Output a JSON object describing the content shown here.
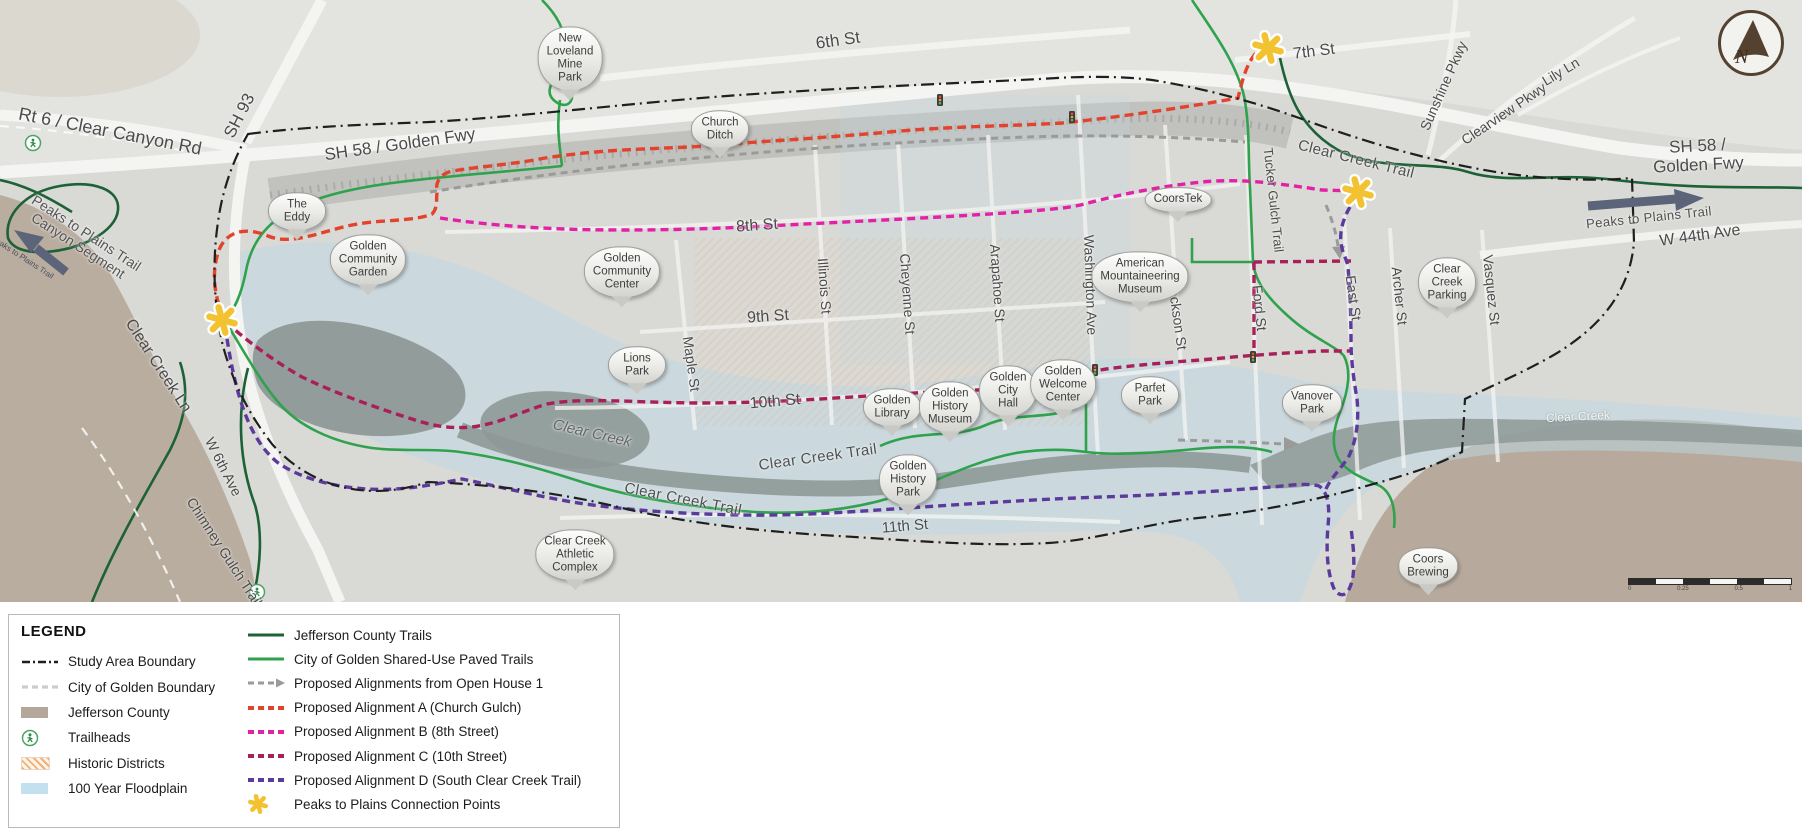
{
  "map": {
    "compass_letter": "N",
    "labels": [
      {
        "t": "Rt 6 / Clear Canyon Rd",
        "x": 110,
        "y": 132,
        "r": 11,
        "s": 18,
        "k": "street"
      },
      {
        "t": "SH 93",
        "x": 240,
        "y": 116,
        "r": -63,
        "s": 17,
        "k": "street"
      },
      {
        "t": "SH 58 / Golden Fwy",
        "x": 400,
        "y": 145,
        "r": -8,
        "s": 17,
        "k": "street"
      },
      {
        "t": "SH 58 / Golden Fwy",
        "x": 1698,
        "y": 156,
        "r": -3,
        "s": 17,
        "k": "street"
      },
      {
        "t": "6th St",
        "x": 838,
        "y": 41,
        "r": -8,
        "s": 17,
        "k": "street"
      },
      {
        "t": "7th St",
        "x": 1314,
        "y": 52,
        "r": -7,
        "s": 16,
        "k": "street"
      },
      {
        "t": "8th St",
        "x": 757,
        "y": 226,
        "r": -4,
        "s": 16,
        "k": "street"
      },
      {
        "t": "9th St",
        "x": 768,
        "y": 317,
        "r": -4,
        "s": 16,
        "k": "street"
      },
      {
        "t": "10th St",
        "x": 775,
        "y": 402,
        "r": -5,
        "s": 16,
        "k": "street"
      },
      {
        "t": "11th St",
        "x": 905,
        "y": 527,
        "r": -5,
        "s": 15,
        "k": "street"
      },
      {
        "t": "Maple St",
        "x": 691,
        "y": 364,
        "r": 82,
        "s": 14,
        "k": "street"
      },
      {
        "t": "Illinois St",
        "x": 824,
        "y": 286,
        "r": 86,
        "s": 14,
        "k": "street"
      },
      {
        "t": "Cheyenne St",
        "x": 907,
        "y": 294,
        "r": 86,
        "s": 14,
        "k": "street"
      },
      {
        "t": "Arapahoe St",
        "x": 997,
        "y": 283,
        "r": 86,
        "s": 14,
        "k": "street"
      },
      {
        "t": "Washington Ave",
        "x": 1090,
        "y": 285,
        "r": 88,
        "s": 14,
        "k": "street"
      },
      {
        "t": "Jackson St",
        "x": 1177,
        "y": 316,
        "r": 82,
        "s": 14,
        "k": "street"
      },
      {
        "t": "Ford St",
        "x": 1259,
        "y": 308,
        "r": 84,
        "s": 14,
        "k": "street"
      },
      {
        "t": "East St",
        "x": 1353,
        "y": 298,
        "r": 82,
        "s": 14,
        "k": "street"
      },
      {
        "t": "Archer St",
        "x": 1399,
        "y": 296,
        "r": 84,
        "s": 14,
        "k": "street"
      },
      {
        "t": "Vasquez St",
        "x": 1491,
        "y": 290,
        "r": 84,
        "s": 14,
        "k": "street"
      },
      {
        "t": "Clear Creek Ln",
        "x": 158,
        "y": 366,
        "r": 57,
        "s": 16,
        "k": "street"
      },
      {
        "t": "W 6th Ave",
        "x": 223,
        "y": 467,
        "r": 63,
        "s": 14,
        "k": "street"
      },
      {
        "t": "Chimney Gulch Trail",
        "x": 224,
        "y": 552,
        "r": 57,
        "s": 14,
        "k": "street"
      },
      {
        "t": "Sunshine Pkwy",
        "x": 1444,
        "y": 86,
        "r": -66,
        "s": 14,
        "k": "street"
      },
      {
        "t": "Clearview Pkwy",
        "x": 1504,
        "y": 114,
        "r": -34,
        "s": 14,
        "k": "street"
      },
      {
        "t": "Lily Ln",
        "x": 1561,
        "y": 72,
        "r": -31,
        "s": 14,
        "k": "street"
      },
      {
        "t": "W 44th Ave",
        "x": 1700,
        "y": 236,
        "r": -8,
        "s": 16,
        "k": "street"
      },
      {
        "t": "Tucker Gulch Trail",
        "x": 1273,
        "y": 200,
        "r": 84,
        "s": 13,
        "k": "street"
      },
      {
        "t": "Clear Creek Trail",
        "x": 1356,
        "y": 160,
        "r": 14,
        "s": 15,
        "k": "trail"
      },
      {
        "t": "Clear Creek Trail",
        "x": 818,
        "y": 458,
        "r": -8,
        "s": 15,
        "k": "trail"
      },
      {
        "t": "Clear Creek Trail",
        "x": 683,
        "y": 500,
        "r": 11,
        "s": 15,
        "k": "trail"
      },
      {
        "t": "Clear Creek",
        "x": 592,
        "y": 434,
        "r": 13,
        "s": 15,
        "k": "creek"
      },
      {
        "t": "Clear Creek",
        "x": 1578,
        "y": 417,
        "r": -3,
        "s": 12,
        "k": "white"
      },
      {
        "t": "Peaks to Plains Trail",
        "x": 1649,
        "y": 218,
        "r": -6,
        "s": 13,
        "k": "trail"
      },
      {
        "t": "Peaks to Plains Trail\nCanyon Segment",
        "x": 82,
        "y": 240,
        "r": 33,
        "s": 14,
        "k": "area"
      },
      {
        "t": "Peaks to Plains Trail",
        "x": 22,
        "y": 258,
        "r": 33,
        "s": 8,
        "k": "tiny"
      }
    ],
    "markers": [
      {
        "lines": [
          "New",
          "Loveland",
          "Mine",
          "Park"
        ],
        "x": 570,
        "y": 100
      },
      {
        "lines": [
          "Church",
          "Ditch"
        ],
        "x": 720,
        "y": 158
      },
      {
        "lines": [
          "The",
          "Eddy"
        ],
        "x": 297,
        "y": 240
      },
      {
        "lines": [
          "Golden",
          "Community",
          "Garden"
        ],
        "x": 368,
        "y": 295
      },
      {
        "lines": [
          "Golden",
          "Community",
          "Center"
        ],
        "x": 622,
        "y": 307
      },
      {
        "lines": [
          "Lions",
          "Park"
        ],
        "x": 637,
        "y": 394
      },
      {
        "lines": [
          "CoorsTek"
        ],
        "x": 1178,
        "y": 222
      },
      {
        "lines": [
          "American",
          "Mountaineering",
          "Museum"
        ],
        "x": 1140,
        "y": 312
      },
      {
        "lines": [
          "Golden",
          "Library"
        ],
        "x": 892,
        "y": 436
      },
      {
        "lines": [
          "Golden",
          "History",
          "Museum"
        ],
        "x": 950,
        "y": 442
      },
      {
        "lines": [
          "Golden",
          "City",
          "Hall"
        ],
        "x": 1008,
        "y": 426
      },
      {
        "lines": [
          "Golden",
          "Welcome",
          "Center"
        ],
        "x": 1063,
        "y": 420
      },
      {
        "lines": [
          "Parfet",
          "Park"
        ],
        "x": 1150,
        "y": 424
      },
      {
        "lines": [
          "Vanover",
          "Park"
        ],
        "x": 1312,
        "y": 432
      },
      {
        "lines": [
          "Clear",
          "Creek",
          "Parking"
        ],
        "x": 1447,
        "y": 318
      },
      {
        "lines": [
          "Golden",
          "History",
          "Park"
        ],
        "x": 908,
        "y": 515
      },
      {
        "lines": [
          "Clear Creek",
          "Athletic",
          "Complex"
        ],
        "x": 575,
        "y": 590
      },
      {
        "lines": [
          "Coors",
          "Brewing"
        ],
        "x": 1428,
        "y": 595
      }
    ],
    "scale_bar": {
      "labels": [
        "0",
        "0.25",
        "0.5",
        "1"
      ]
    }
  },
  "legend": {
    "title": "LEGEND",
    "left_items": [
      {
        "label": "Study Area Boundary",
        "swatch": "dashdot"
      },
      {
        "label": "City of Golden Boundary",
        "swatch": "citydash"
      },
      {
        "label": "Jefferson County",
        "swatch": "fill-county"
      },
      {
        "label": "Trailheads",
        "swatch": "trailhead"
      },
      {
        "label": "Historic Districts",
        "swatch": "historic"
      },
      {
        "label": "100 Year Floodplain",
        "swatch": "fill-flood"
      }
    ],
    "right_items": [
      {
        "label": "Jefferson County Trails",
        "swatch": "line-jeffco"
      },
      {
        "label": "City of Golden Shared-Use Paved Trails",
        "swatch": "line-golden"
      },
      {
        "label": "Proposed Alignments from Open House 1",
        "swatch": "dash-gray-arrow"
      },
      {
        "label": "Proposed Alignment A (Church Gulch)",
        "swatch": "dash-a"
      },
      {
        "label": "Proposed Alignment B (8th Street)",
        "swatch": "dash-b"
      },
      {
        "label": "Proposed Alignment C (10th Street)",
        "swatch": "dash-c"
      },
      {
        "label": "Proposed Alignment D (South Clear Creek Trail)",
        "swatch": "dash-d"
      },
      {
        "label": "Peaks to Plains Connection Points",
        "swatch": "star"
      }
    ]
  },
  "colors": {
    "alignment_a": "#E2432C",
    "alignment_b": "#E321A6",
    "alignment_c": "#A82058",
    "alignment_d": "#5C3A9C",
    "jeffco_trails": "#1D6136",
    "golden_trails": "#2FA24E",
    "open_house": "#9A9A9A",
    "study_boundary": "#1F1F1F",
    "city_boundary": "#FBFBF9",
    "star": "#F2C230",
    "jefferson_county_fill": "#B5A79A",
    "floodplain": "#C3E0EF",
    "historic": "#F2B078",
    "arrow": "#5B6478",
    "compass": "#55412F"
  }
}
